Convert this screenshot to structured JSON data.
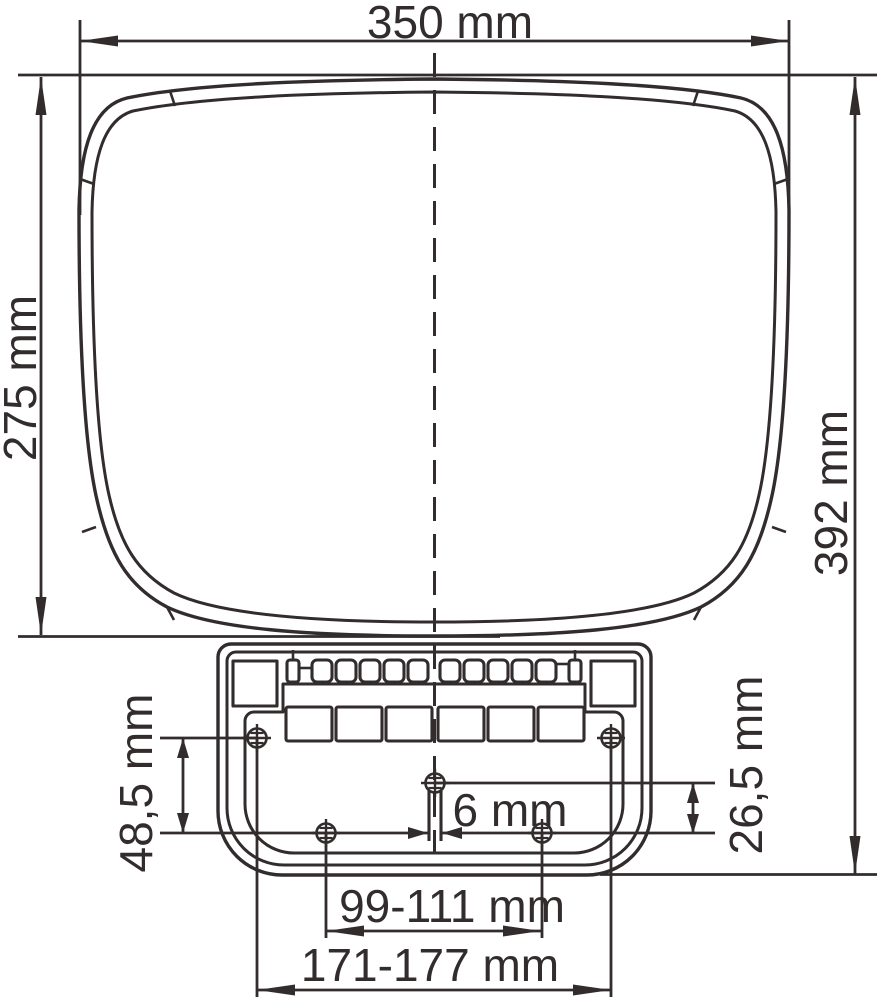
{
  "drawing": {
    "type": "technical-dimension-drawing",
    "units": "mm",
    "labels": {
      "overall_width": "350 mm",
      "body_height": "275 mm",
      "overall_height": "392 mm",
      "hole_row_spacing": "48,5 mm",
      "hole_center_offset": "26,5 mm",
      "slot_width": "6 mm",
      "inner_hole_span": "99-111 mm",
      "outer_hole_span": "171-177 mm"
    },
    "colors": {
      "line": "#322c2d",
      "background": "#ffffff"
    }
  }
}
